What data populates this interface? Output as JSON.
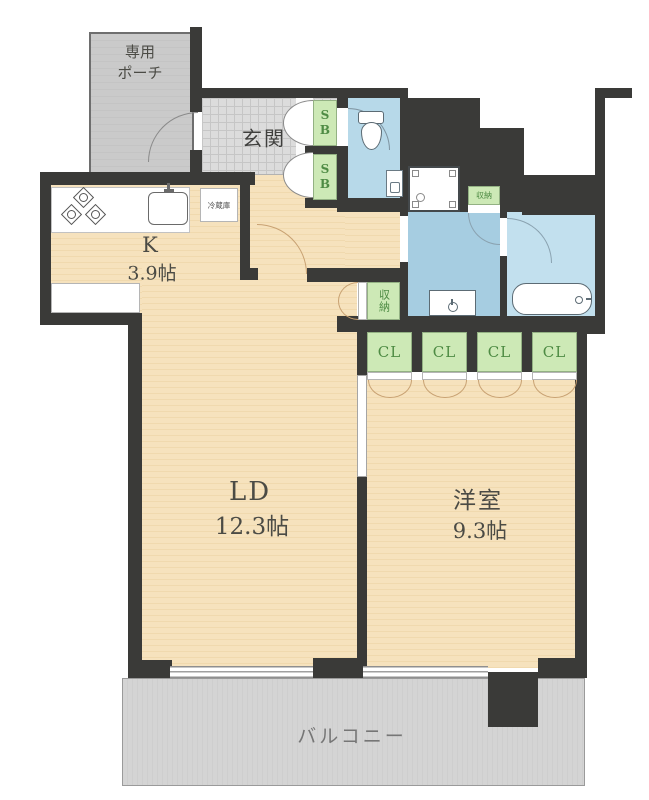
{
  "title": "1LDK apartment floor plan",
  "labels": {
    "porch": [
      "専用",
      "ポーチ"
    ],
    "entrance": "玄関",
    "shoe_box": "SB",
    "refrigerator": "冷蔵庫",
    "kitchen": {
      "name": "K",
      "size": "3.9帖"
    },
    "storage": "収納",
    "closet": "CL",
    "living_dining": {
      "name": "LD",
      "size": "12.3帖"
    },
    "western_room": {
      "name": "洋室",
      "size": "9.3帖"
    },
    "balcony": "バルコニー"
  },
  "colors": {
    "wall": "#3a3a38",
    "floor_wood": "#f4ddb4",
    "entrance_tile": "#dcdcdc",
    "porch_gray": "#c9c9c9",
    "balcony_gray": "#d2d2d2",
    "washroom_blue": "#a6cde1",
    "bath_blue": "#c2e0ee",
    "toilet_blue": "#b7d9e9",
    "closet_green": "#cde9b6",
    "green_text": "#4e8b44",
    "label_dark": "#4b4b45"
  }
}
